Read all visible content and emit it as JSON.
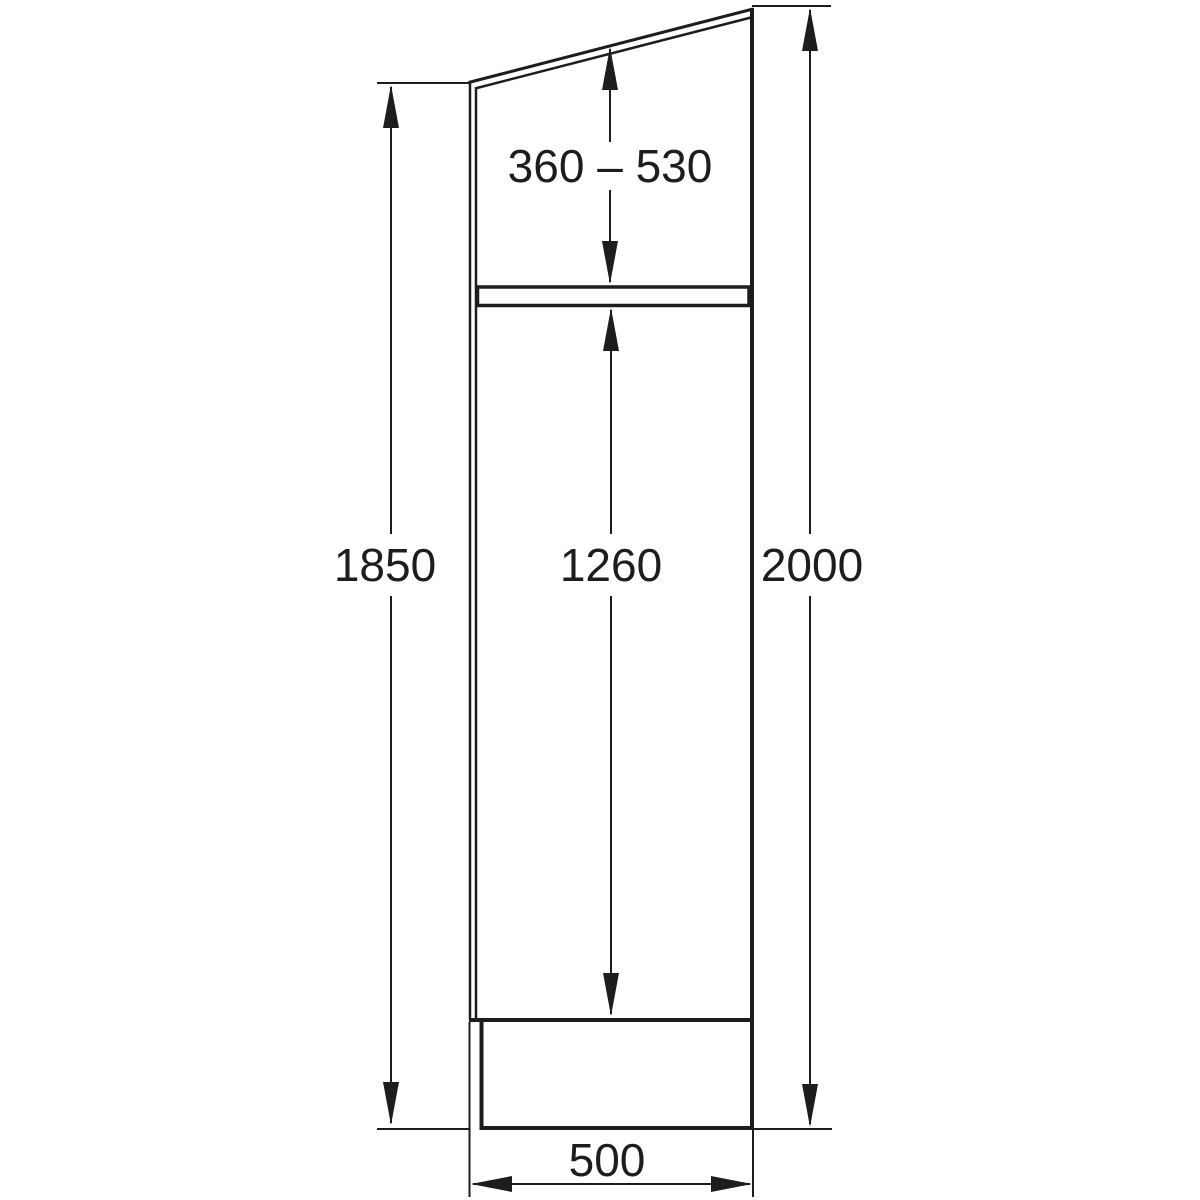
{
  "drawing": {
    "kind": "technical-dimension-drawing",
    "subject": "tall-cabinet-side-view"
  },
  "dimensions": {
    "top": "360 – 530",
    "left": "1850",
    "middle": "1260",
    "right": "2000",
    "bottom": "500"
  },
  "style": {
    "line_color": "#1d1d1b",
    "background_color": "#ffffff"
  }
}
